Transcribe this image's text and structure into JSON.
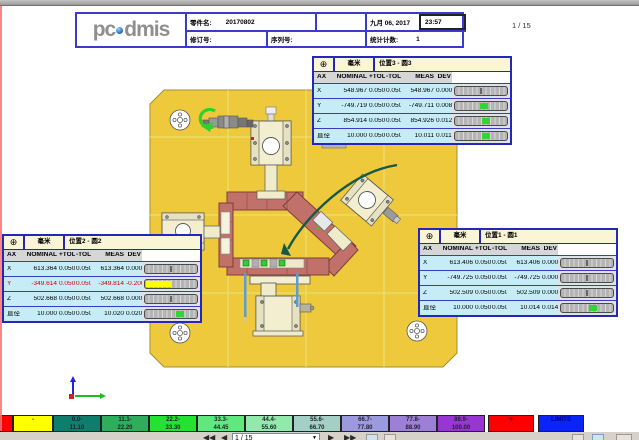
{
  "header": {
    "logo_pc": "pc",
    "logo_dmis": "dmis",
    "part_label": "零件名:",
    "part_value": "20170802",
    "date": "九月 06, 2017",
    "time": "23:57",
    "rev_label": "修订号:",
    "serial_label": "序列号:",
    "stats_label": "统计计数:",
    "stats_value": "1",
    "page_indicator": "1 / 15"
  },
  "tables": [
    {
      "name": "pos3",
      "symbol": "⊕",
      "units": "毫米",
      "title": "位置3 - 圆3",
      "tol": 0.05,
      "columns": [
        "AX",
        "NOMINAL",
        "+TOL",
        "-TOL",
        "MEAS",
        "DEV"
      ],
      "rows": [
        {
          "ax": "X",
          "nominal": "548.967",
          "ptol": "0.050",
          "ntol": "0.050",
          "meas": "548.967",
          "dev": "0.000",
          "dev_num": 0.0,
          "oot": false
        },
        {
          "ax": "Y",
          "nominal": "-749.719",
          "ptol": "0.050",
          "ntol": "0.050",
          "meas": "-749.711",
          "dev": "0.008",
          "dev_num": 0.008,
          "oot": false
        },
        {
          "ax": "Z",
          "nominal": "854.914",
          "ptol": "0.050",
          "ntol": "0.050",
          "meas": "854.926",
          "dev": "0.012",
          "dev_num": 0.012,
          "oot": false
        },
        {
          "ax": "直径",
          "nominal": "10.000",
          "ptol": "0.050",
          "ntol": "0.050",
          "meas": "10.011",
          "dev": "0.011",
          "dev_num": 0.011,
          "oot": false
        }
      ]
    },
    {
      "name": "pos2",
      "symbol": "⊕",
      "units": "毫米",
      "title": "位置2 - 圆2",
      "tol": 0.05,
      "columns": [
        "AX",
        "NOMINAL",
        "+TOL",
        "-TOL",
        "MEAS",
        "DEV"
      ],
      "rows": [
        {
          "ax": "X",
          "nominal": "613.364",
          "ptol": "0.050",
          "ntol": "0.050",
          "meas": "613.364",
          "dev": "0.000",
          "dev_num": 0.0,
          "oot": false
        },
        {
          "ax": "Y",
          "nominal": "-349.614",
          "ptol": "0.050",
          "ntol": "0.050",
          "meas": "-349.814",
          "dev": "-0.200",
          "dev_num": -0.2,
          "oot": true
        },
        {
          "ax": "Z",
          "nominal": "502.668",
          "ptol": "0.050",
          "ntol": "0.050",
          "meas": "502.668",
          "dev": "0.000",
          "dev_num": 0.0,
          "oot": false
        },
        {
          "ax": "直径",
          "nominal": "10.000",
          "ptol": "0.050",
          "ntol": "0.050",
          "meas": "10.020",
          "dev": "0.020",
          "dev_num": 0.02,
          "oot": false
        }
      ]
    },
    {
      "name": "pos1",
      "symbol": "⊕",
      "units": "毫米",
      "title": "位置1 - 圆1",
      "tol": 0.05,
      "columns": [
        "AX",
        "NOMINAL",
        "+TOL",
        "-TOL",
        "MEAS",
        "DEV"
      ],
      "rows": [
        {
          "ax": "X",
          "nominal": "613.406",
          "ptol": "0.050",
          "ntol": "0.050",
          "meas": "613.406",
          "dev": "0.000",
          "dev_num": 0.0,
          "oot": false
        },
        {
          "ax": "Y",
          "nominal": "-749.725",
          "ptol": "0.050",
          "ntol": "0.050",
          "meas": "-749.725",
          "dev": "0.000",
          "dev_num": 0.0,
          "oot": false
        },
        {
          "ax": "Z",
          "nominal": "502.509",
          "ptol": "0.050",
          "ntol": "0.050",
          "meas": "502.509",
          "dev": "0.000",
          "dev_num": 0.0,
          "oot": false
        },
        {
          "ax": "直径",
          "nominal": "10.000",
          "ptol": "0.050",
          "ntol": "0.050",
          "meas": "10.014",
          "dev": "0.014",
          "dev_num": 0.014,
          "oot": false
        }
      ]
    }
  ],
  "colorbar": {
    "segments": [
      {
        "label1": "",
        "label2": "",
        "color": "#ff0000",
        "width": 13,
        "gap": 0,
        "text": "#000000"
      },
      {
        "label1": "-",
        "label2": "",
        "color": "#ffff00",
        "width": 40,
        "gap": 0,
        "text": "#000000"
      },
      {
        "label1": "0.0-",
        "label2": "11.10",
        "color": "#0e7d6b",
        "width": 48,
        "gap": 0,
        "text": "#23232e"
      },
      {
        "label1": "11.1-",
        "label2": "22.20",
        "color": "#2eae5c",
        "width": 48,
        "gap": 0,
        "text": "#23232e"
      },
      {
        "label1": "22.2-",
        "label2": "33.30",
        "color": "#22e32f",
        "width": 48,
        "gap": 0,
        "text": "#23232e"
      },
      {
        "label1": "33.3-",
        "label2": "44.45",
        "color": "#5fe87d",
        "width": 48,
        "gap": 0,
        "text": "#23232e"
      },
      {
        "label1": "44.4-",
        "label2": "55.60",
        "color": "#93e9ab",
        "width": 48,
        "gap": 0,
        "text": "#23232e"
      },
      {
        "label1": "55.6-",
        "label2": "66.70",
        "color": "#a3cfc4",
        "width": 48,
        "gap": 0,
        "text": "#23232e"
      },
      {
        "label1": "66.7-",
        "label2": "77.80",
        "color": "#9c9ade",
        "width": 48,
        "gap": 0,
        "text": "#23232e"
      },
      {
        "label1": "77.8-",
        "label2": "88.90",
        "color": "#9d7fd6",
        "width": 48,
        "gap": 0,
        "text": "#23232e"
      },
      {
        "label1": "88.9-",
        "label2": "100.00",
        "color": "#9836d3",
        "width": 48,
        "gap": 0,
        "text": "#23232e"
      },
      {
        "label1": "+",
        "label2": "",
        "color": "#ff0000",
        "width": 46,
        "gap": 3,
        "text": "#000000"
      },
      {
        "label1": "LIMITS",
        "label2": "",
        "color": "#0b24f5",
        "width": 46,
        "gap": 4,
        "text": "#000080"
      }
    ]
  },
  "toolbar": {
    "page_value": "1 / 15",
    "icons": {
      "first_page": "◀◀",
      "prev_page": "◀",
      "next_page": "▶",
      "last_page": "▶▶",
      "dropdown_arrow": "▼"
    }
  }
}
